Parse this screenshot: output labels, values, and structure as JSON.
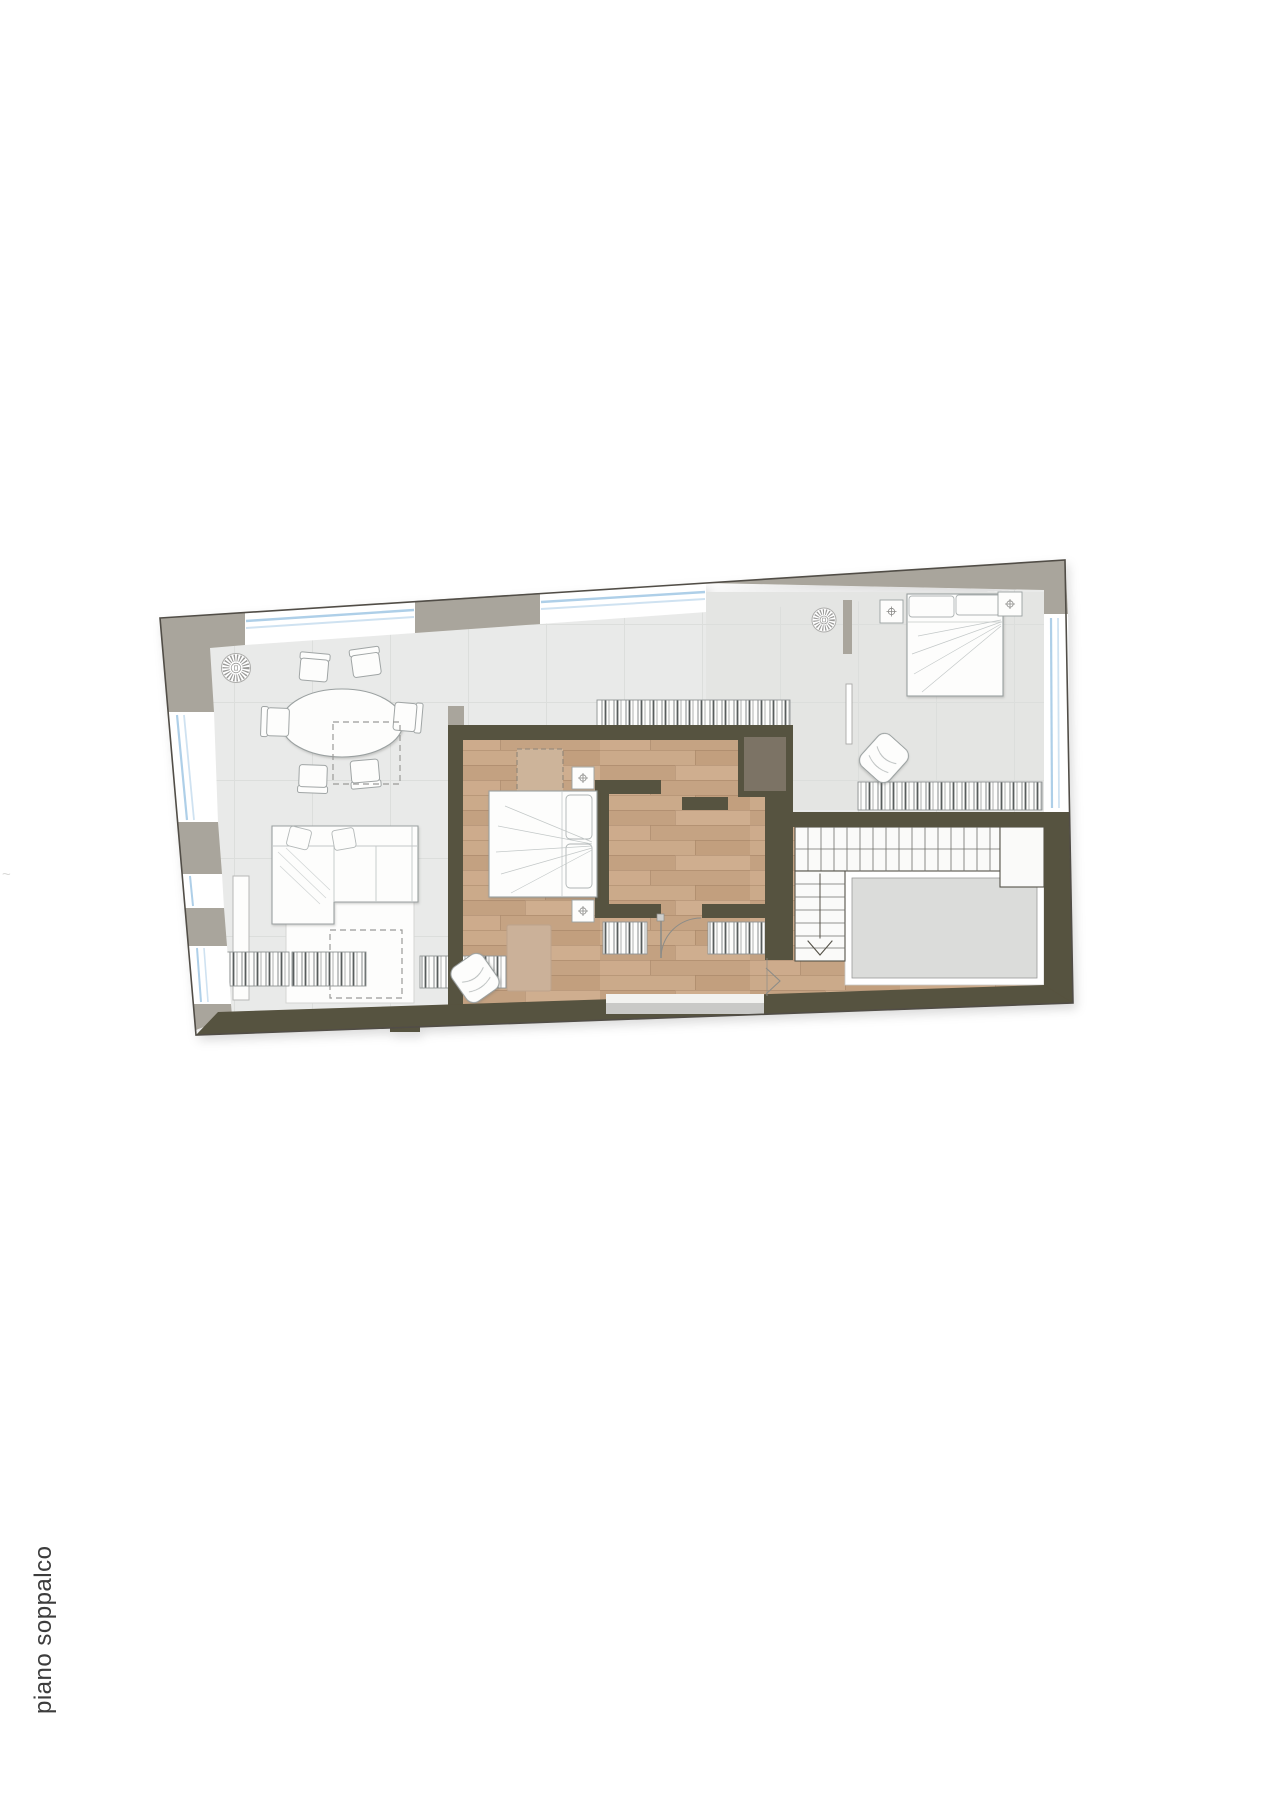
{
  "page": {
    "width": 1280,
    "height": 1810,
    "background": "#ffffff",
    "floor_label": "piano soppalco",
    "label_color": "#3c3c3c",
    "stray_mark": "~"
  },
  "palette": {
    "exterior_wall_gray": "#a9a59c",
    "interior_wall_dark": "#57523f",
    "tile_floor": "#e9eae9",
    "bedroom_tile": "#e4e5e3",
    "tile_joint": "#dcdedc",
    "wood_floor": "#c9a887",
    "void_opening": "#dbdcda",
    "window_glass_blue": "#aecfe8",
    "closet_fill": "#7c7365",
    "outline_dark": "#514e46",
    "furniture_outline": "#9aa0a0",
    "radiator_hatch": "#585d5d",
    "rug_tan": "#cbb199",
    "rug_white": "#fdfdfc"
  },
  "plan_items": [
    "dining-table-oval",
    "dining-chairs-x6",
    "sectional-sofa",
    "white-rug",
    "dashed-projection-squares",
    "wall-cabinet",
    "ceiling-fan-x2",
    "double-bed-mezzanine-room",
    "double-bed-top-bedroom",
    "nightstand-lamp-markers-x4",
    "armchair-x2",
    "tan-rug",
    "wardrobe-inset",
    "radiator-convectors",
    "closet-niche",
    "door-swing",
    "u-staircase",
    "floor-void-opening",
    "window-strips",
    "level-change-arrows"
  ],
  "symbols": {
    "lamp_marker": "circle-with-cross",
    "ceiling_fan": "radial-tick-medallion",
    "stair_direction": "chevron-down",
    "level_change": "chevron-right"
  }
}
